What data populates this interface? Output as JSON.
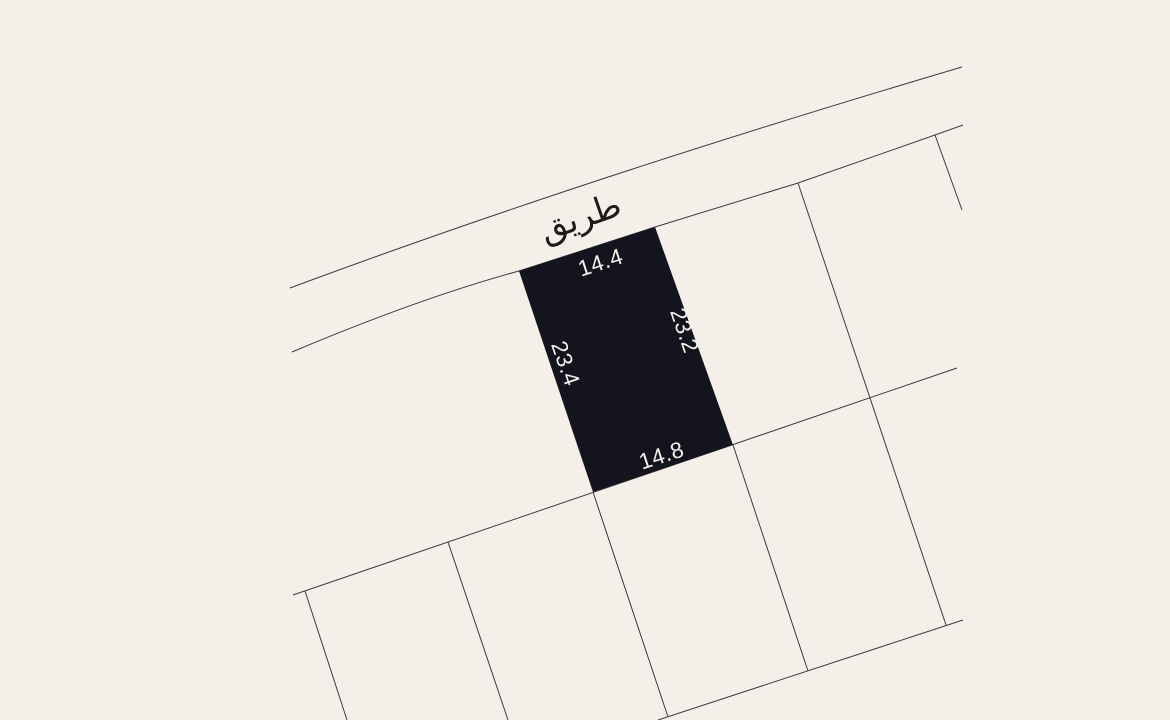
{
  "colors": {
    "background": "#f4efe9",
    "boundary_line": "#3c3c3c",
    "parcel_fill": "#14141f",
    "dimension_text": "#f5f1ea",
    "road_text": "#1c1c1c"
  },
  "road": {
    "label": "طريق"
  },
  "parcel": {
    "dimensions": {
      "top": "14.4",
      "right": "23.2",
      "left": "23.4",
      "bottom": "14.8"
    }
  }
}
